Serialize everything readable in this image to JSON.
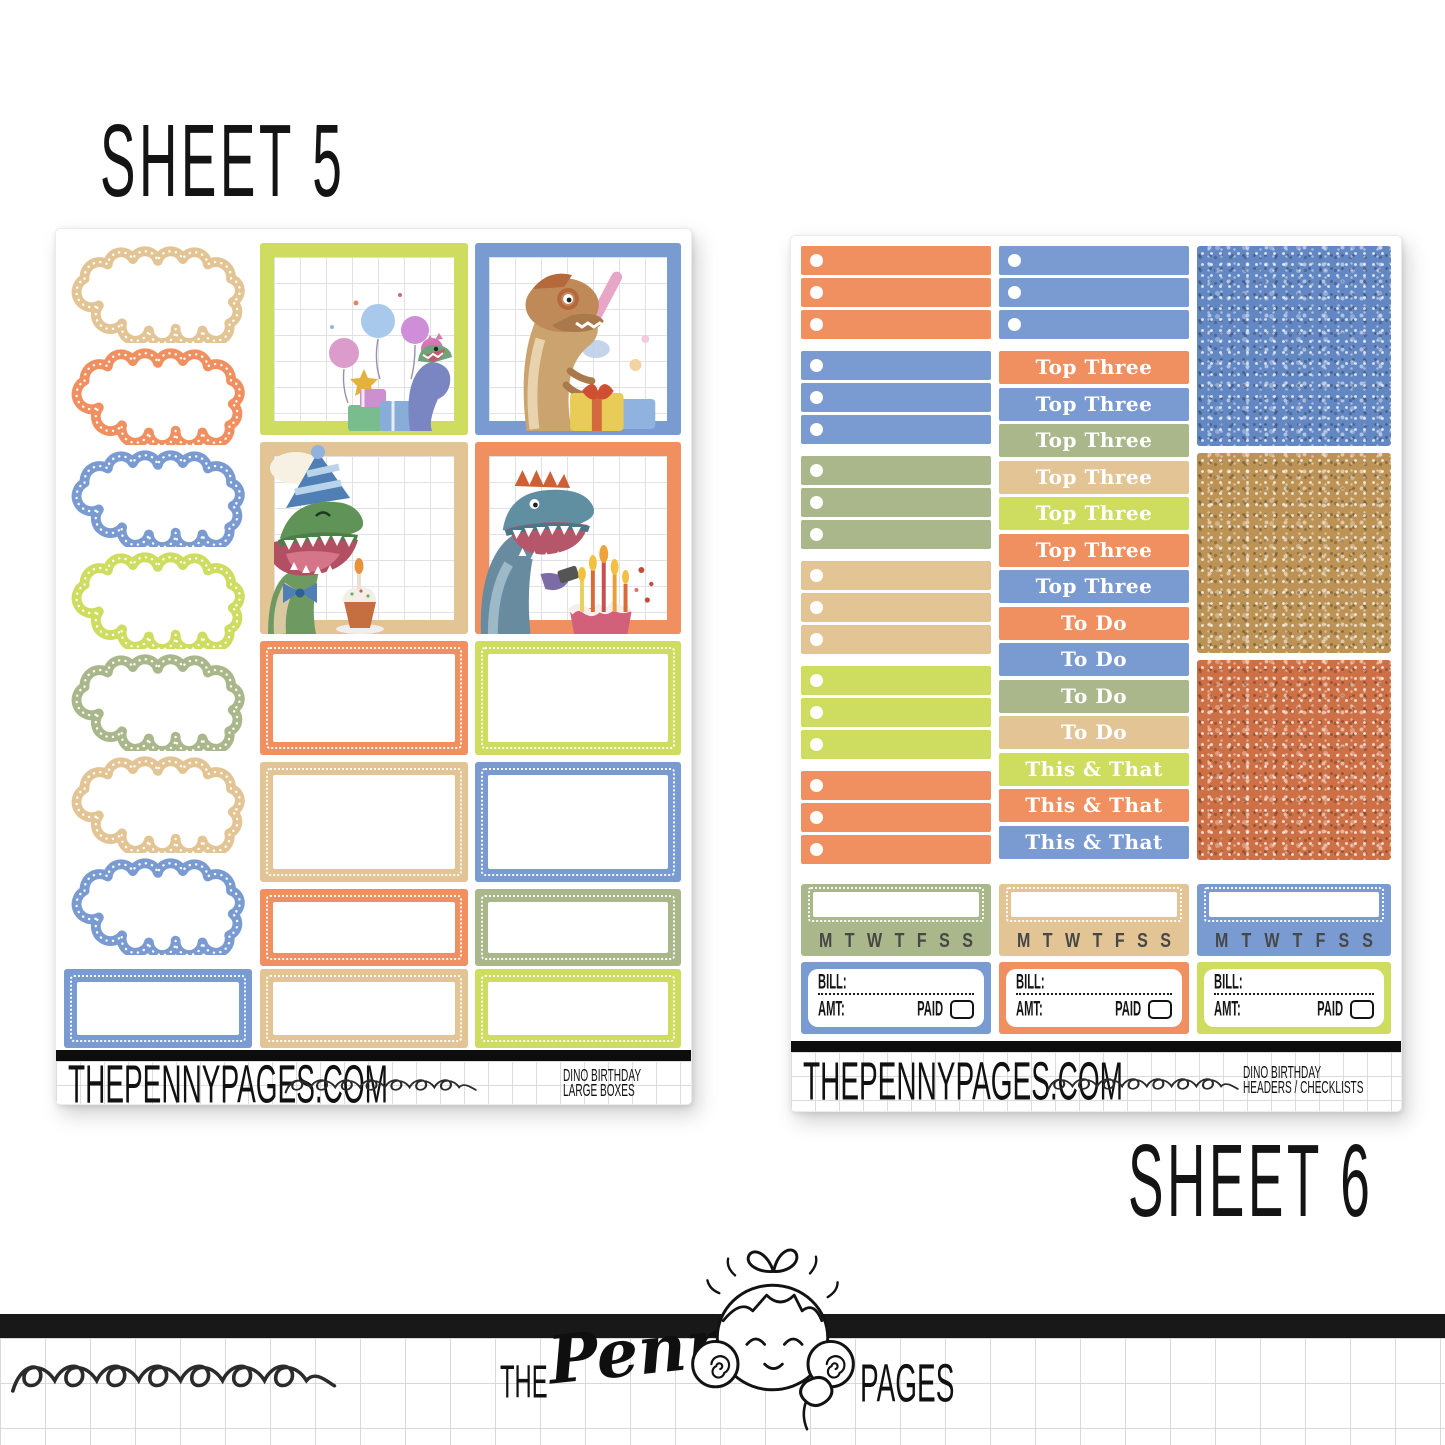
{
  "labels": {
    "sheet5": "SHEET 5",
    "sheet6": "SHEET 6"
  },
  "palette": {
    "orange": "#F09060",
    "blue": "#7A9BD1",
    "olive": "#A9B78A",
    "tan": "#E3C495",
    "lime": "#CEDC5F",
    "black_bar": "#0d0d0d"
  },
  "sheet5": {
    "clouds": [
      "#E3C495",
      "#F09060",
      "#7A9BD1",
      "#CEDC5F",
      "#A9B78A",
      "#E3C495",
      "#7A9BD1"
    ],
    "bottom_left_box": "#7A9BD1",
    "photo_boxes": [
      "#CEDC5F",
      "#7A9BD1",
      "#E3C495",
      "#F09060"
    ],
    "half_boxes": [
      "#F09060",
      "#CEDC5F",
      "#E3C495",
      "#7A9BD1"
    ],
    "short_boxes": [
      "#F09060",
      "#A9B78A"
    ],
    "bottom_boxes": [
      "#E3C495",
      "#CEDC5F"
    ],
    "footer": {
      "site": "THEPENNYPAGES.COM",
      "label_line1": "DINO BIRTHDAY",
      "label_line2": "LARGE BOXES"
    }
  },
  "sheet6": {
    "checklist_groups": [
      "#F09060",
      "#7A9BD1",
      "#A9B78A",
      "#E3C495",
      "#CEDC5F",
      "#F09060"
    ],
    "top_checklist": "#7A9BD1",
    "headers": [
      {
        "label": "Top Three",
        "color": "#F09060"
      },
      {
        "label": "Top Three",
        "color": "#7A9BD1"
      },
      {
        "label": "Top Three",
        "color": "#A9B78A"
      },
      {
        "label": "Top Three",
        "color": "#E3C495"
      },
      {
        "label": "Top Three",
        "color": "#CEDC5F"
      },
      {
        "label": "Top Three",
        "color": "#F09060"
      },
      {
        "label": "Top Three",
        "color": "#7A9BD1"
      },
      {
        "label": "To Do",
        "color": "#F09060"
      },
      {
        "label": "To Do",
        "color": "#7A9BD1"
      },
      {
        "label": "To Do",
        "color": "#A9B78A"
      },
      {
        "label": "To Do",
        "color": "#E3C495"
      },
      {
        "label": "This & That",
        "color": "#CEDC5F"
      },
      {
        "label": "This & That",
        "color": "#F09060"
      },
      {
        "label": "This & That",
        "color": "#7A9BD1"
      }
    ],
    "glitters": [
      {
        "name": "blue-glitter",
        "base": "#6287C2"
      },
      {
        "name": "gold-glitter",
        "base": "#BC9255"
      },
      {
        "name": "orange-glitter",
        "base": "#CE7045"
      }
    ],
    "date_covers": {
      "colors": [
        "#A9B78A",
        "#E3C495",
        "#7A9BD1"
      ],
      "days": [
        "M",
        "T",
        "W",
        "T",
        "F",
        "S",
        "S"
      ]
    },
    "bill_stickers": {
      "colors": [
        "#7A9BD1",
        "#F09060",
        "#CEDC5F"
      ],
      "bill_label": "BILL:",
      "amt_label": "AMT:",
      "paid_label": "PAID"
    },
    "footer": {
      "site": "THEPENNYPAGES.COM",
      "label_line1": "DINO BIRTHDAY",
      "label_line2": "HEADERS / CHECKLISTS"
    }
  },
  "logo": {
    "the": "THE",
    "penny": "Penny",
    "pages": "PAGES"
  }
}
